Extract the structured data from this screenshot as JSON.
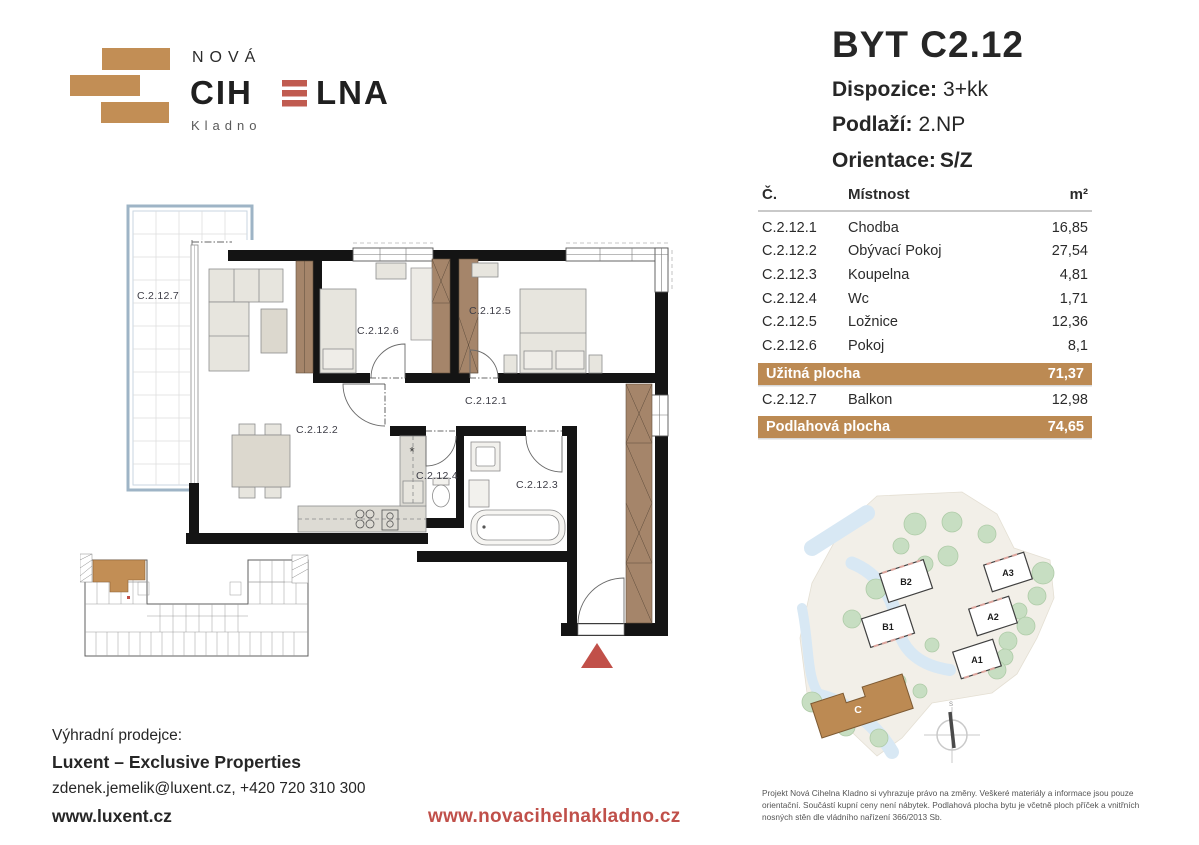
{
  "colors": {
    "tan": "#BC8A53",
    "brick": "#C28E55",
    "red": "#C0504A",
    "dark": "#262626"
  },
  "logo": {
    "top": "NOVÁ",
    "name_left": "CIH",
    "name_right": "LNA",
    "city": "Kladno"
  },
  "header": {
    "title": "BYT C2.12",
    "specs": [
      {
        "label": "Dispozice:",
        "value": "3+kk"
      },
      {
        "label": "Podlaží:",
        "value": "2.NP"
      },
      {
        "label": "Orientace:",
        "value": "S/Z"
      }
    ]
  },
  "table": {
    "col_code": "Č.",
    "col_room": "Místnost",
    "col_area": "m²",
    "rows": [
      {
        "code": "C.2.12.1",
        "name": "Chodba",
        "area": "16,85"
      },
      {
        "code": "C.2.12.2",
        "name": "Obývací Pokoj",
        "area": "27,54"
      },
      {
        "code": "C.2.12.3",
        "name": "Koupelna",
        "area": "4,81"
      },
      {
        "code": "C.2.12.4",
        "name": "Wc",
        "area": "1,71"
      },
      {
        "code": "C.2.12.5",
        "name": "Ložnice",
        "area": "12,36"
      },
      {
        "code": "C.2.12.6",
        "name": "Pokoj",
        "area": "8,1"
      }
    ],
    "usable": {
      "label": "Užitná plocha",
      "value": "71,37"
    },
    "balcony": {
      "code": "C.2.12.7",
      "name": "Balkon",
      "area": "12,98"
    },
    "floor": {
      "label": "Podlahová plocha",
      "value": "74,65"
    }
  },
  "plan": {
    "labels": {
      "balcony": "C.2.12.7",
      "living": "C.2.12.2",
      "room": "C.2.12.6",
      "bedroom": "C.2.12.5",
      "hall": "C.2.12.1",
      "wc": "C.2.12.4",
      "bath": "C.2.12.3"
    }
  },
  "site": {
    "buildings": [
      "B2",
      "B1",
      "A3",
      "A2",
      "A1"
    ],
    "highlight": "C",
    "compass": "S"
  },
  "footer": {
    "seller_label": "Výhradní prodejce:",
    "seller_name": "Luxent – Exclusive Properties",
    "contact": "zdenek.jemelik@luxent.cz, +420 720 310 300",
    "seller_web": "www.luxent.cz",
    "project_web": "www.novacihelnakladno.cz",
    "disclaimer": "Projekt Nová Cihelna Kladno si vyhrazuje právo na změny. Veškeré materiály a informace jsou pouze orientační. Součástí kupní ceny není nábytek. Podlahová plocha bytu je včetně ploch příček a vnitřních nosných stěn dle vládního nařízení 366/2013 Sb."
  }
}
